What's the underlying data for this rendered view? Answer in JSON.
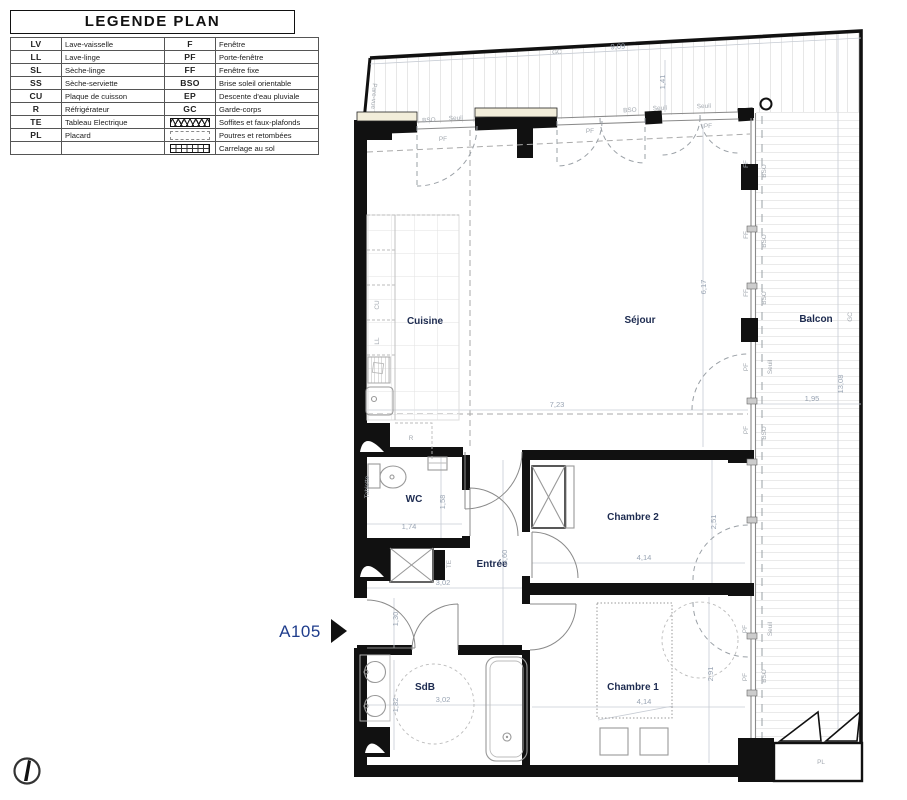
{
  "colors": {
    "wall": "#111111",
    "room_label": "#1d2b50",
    "dimension": "#9aa5b4",
    "annotation": "#a3a9b0",
    "unit_label": "#1f3d8c",
    "sill_cream": "#f2edda",
    "hatch": "#cfcfcf"
  },
  "legend": {
    "title": "LEGENDE PLAN",
    "rows": [
      {
        "lc": "LV",
        "ll": "Lave-vaisselle",
        "rc": "F",
        "rl": "Fenêtre"
      },
      {
        "lc": "LL",
        "ll": "Lave-linge",
        "rc": "PF",
        "rl": "Porte-fenêtre"
      },
      {
        "lc": "SL",
        "ll": "Sèche-linge",
        "rc": "FF",
        "rl": "Fenêtre fixe"
      },
      {
        "lc": "SS",
        "ll": "Sèche-serviette",
        "rc": "BSO",
        "rl": "Brise soleil orientable"
      },
      {
        "lc": "CU",
        "ll": "Plaque de cuisson",
        "rc": "EP",
        "rl": "Descente d'eau pluviale"
      },
      {
        "lc": "R",
        "ll": "Réfrigérateur",
        "rc": "GC",
        "rl": "Garde-corps"
      },
      {
        "lc": "TE",
        "ll": "Tableau Electrique",
        "rc": "",
        "rl": "Soffites et faux-plafonds"
      },
      {
        "lc": "PL",
        "ll": "Placard",
        "rc": "",
        "rl": "Poutres et retombées"
      },
      {
        "lc": "",
        "ll": "",
        "rc": "",
        "rl": "Carrelage au sol"
      }
    ]
  },
  "plan": {
    "unit_label": "A105",
    "rooms": [
      {
        "t": "Cuisine",
        "x": 425,
        "y": 324
      },
      {
        "t": "Séjour",
        "x": 640,
        "y": 323
      },
      {
        "t": "Balcon",
        "x": 816,
        "y": 322
      },
      {
        "t": "WC",
        "x": 414,
        "y": 502
      },
      {
        "t": "Entrée",
        "x": 492,
        "y": 567
      },
      {
        "t": "Chambre 2",
        "x": 633,
        "y": 520
      },
      {
        "t": "Chambre 1",
        "x": 633,
        "y": 690
      },
      {
        "t": "SdB",
        "x": 425,
        "y": 690
      }
    ],
    "dims": [
      {
        "t": "9,09",
        "x": 618,
        "y": 49,
        "r": -3
      },
      {
        "t": "1,41",
        "x": 665,
        "y": 82,
        "r": -90
      },
      {
        "t": "7,23",
        "x": 557,
        "y": 407
      },
      {
        "t": "6,17",
        "x": 706,
        "y": 287,
        "r": -90
      },
      {
        "t": "13,08",
        "x": 843,
        "y": 384,
        "r": -90
      },
      {
        "t": "1,95",
        "x": 812,
        "y": 401
      },
      {
        "t": "1,74",
        "x": 409,
        "y": 529
      },
      {
        "t": "1,58",
        "x": 445,
        "y": 502,
        "r": -90
      },
      {
        "t": "3,02",
        "x": 443,
        "y": 585
      },
      {
        "t": "3,60",
        "x": 507,
        "y": 557,
        "r": -90
      },
      {
        "t": "4,14",
        "x": 644,
        "y": 560
      },
      {
        "t": "2,51",
        "x": 716,
        "y": 522,
        "r": -90
      },
      {
        "t": "4,14",
        "x": 644,
        "y": 704
      },
      {
        "t": "2,91",
        "x": 713,
        "y": 674,
        "r": -90
      },
      {
        "t": "3,02",
        "x": 443,
        "y": 702
      },
      {
        "t": "1,82",
        "x": 398,
        "y": 705,
        "r": -90
      },
      {
        "t": "1,30",
        "x": 398,
        "y": 619,
        "r": -90
      }
    ],
    "annots": [
      {
        "t": "GC",
        "x": 557,
        "y": 54,
        "r": -3
      },
      {
        "t": "GC",
        "x": 852,
        "y": 317,
        "r": -90
      },
      {
        "t": "Pare-vue",
        "x": 372,
        "y": 96,
        "r": 94,
        "s": 6
      },
      {
        "t": "PF",
        "x": 443,
        "y": 141
      },
      {
        "t": "PF",
        "x": 590,
        "y": 133
      },
      {
        "t": "PF",
        "x": 708,
        "y": 128
      },
      {
        "t": "BSO",
        "x": 429,
        "y": 122,
        "r": -3,
        "s": 5.5
      },
      {
        "t": "Seuil",
        "x": 456,
        "y": 120,
        "r": -3,
        "s": 5.5
      },
      {
        "t": "BSO",
        "x": 630,
        "y": 112,
        "r": -3,
        "s": 5.5
      },
      {
        "t": "Seuil",
        "x": 660,
        "y": 110,
        "r": -3,
        "s": 5.5
      },
      {
        "t": "Seuil",
        "x": 704,
        "y": 108,
        "r": -3,
        "s": 5.5
      },
      {
        "t": "FF",
        "x": 748,
        "y": 164,
        "r": -90
      },
      {
        "t": "FF",
        "x": 748,
        "y": 235,
        "r": -90
      },
      {
        "t": "FF",
        "x": 748,
        "y": 293,
        "r": -90
      },
      {
        "t": "PF",
        "x": 748,
        "y": 367,
        "r": -90
      },
      {
        "t": "PF",
        "x": 748,
        "y": 430,
        "r": -90
      },
      {
        "t": "PF",
        "x": 747,
        "y": 629,
        "r": -90
      },
      {
        "t": "PF",
        "x": 747,
        "y": 677,
        "r": -90
      },
      {
        "t": "BSO",
        "x": 766,
        "y": 171,
        "r": -90,
        "s": 5.5
      },
      {
        "t": "BSO",
        "x": 766,
        "y": 241,
        "r": -90,
        "s": 5.5
      },
      {
        "t": "BSO",
        "x": 766,
        "y": 298,
        "r": -90,
        "s": 5.5
      },
      {
        "t": "BSO",
        "x": 766,
        "y": 433,
        "r": -90,
        "s": 5.5
      },
      {
        "t": "BSO",
        "x": 766,
        "y": 676,
        "r": -90,
        "s": 5.5
      },
      {
        "t": "Seuil",
        "x": 772,
        "y": 367,
        "r": -90,
        "s": 5.5
      },
      {
        "t": "Seuil",
        "x": 772,
        "y": 629,
        "r": -90,
        "s": 5.5
      },
      {
        "t": "CU",
        "x": 379,
        "y": 305,
        "r": -90
      },
      {
        "t": "LL",
        "x": 379,
        "y": 341,
        "r": -90
      },
      {
        "t": "R",
        "x": 411,
        "y": 440
      },
      {
        "t": "TE",
        "x": 451,
        "y": 564,
        "r": -90
      },
      {
        "t": "Tablette",
        "x": 369,
        "y": 487,
        "r": -90,
        "s": 5
      },
      {
        "t": "PL",
        "x": 821,
        "y": 764,
        "s": 7.5
      }
    ]
  }
}
